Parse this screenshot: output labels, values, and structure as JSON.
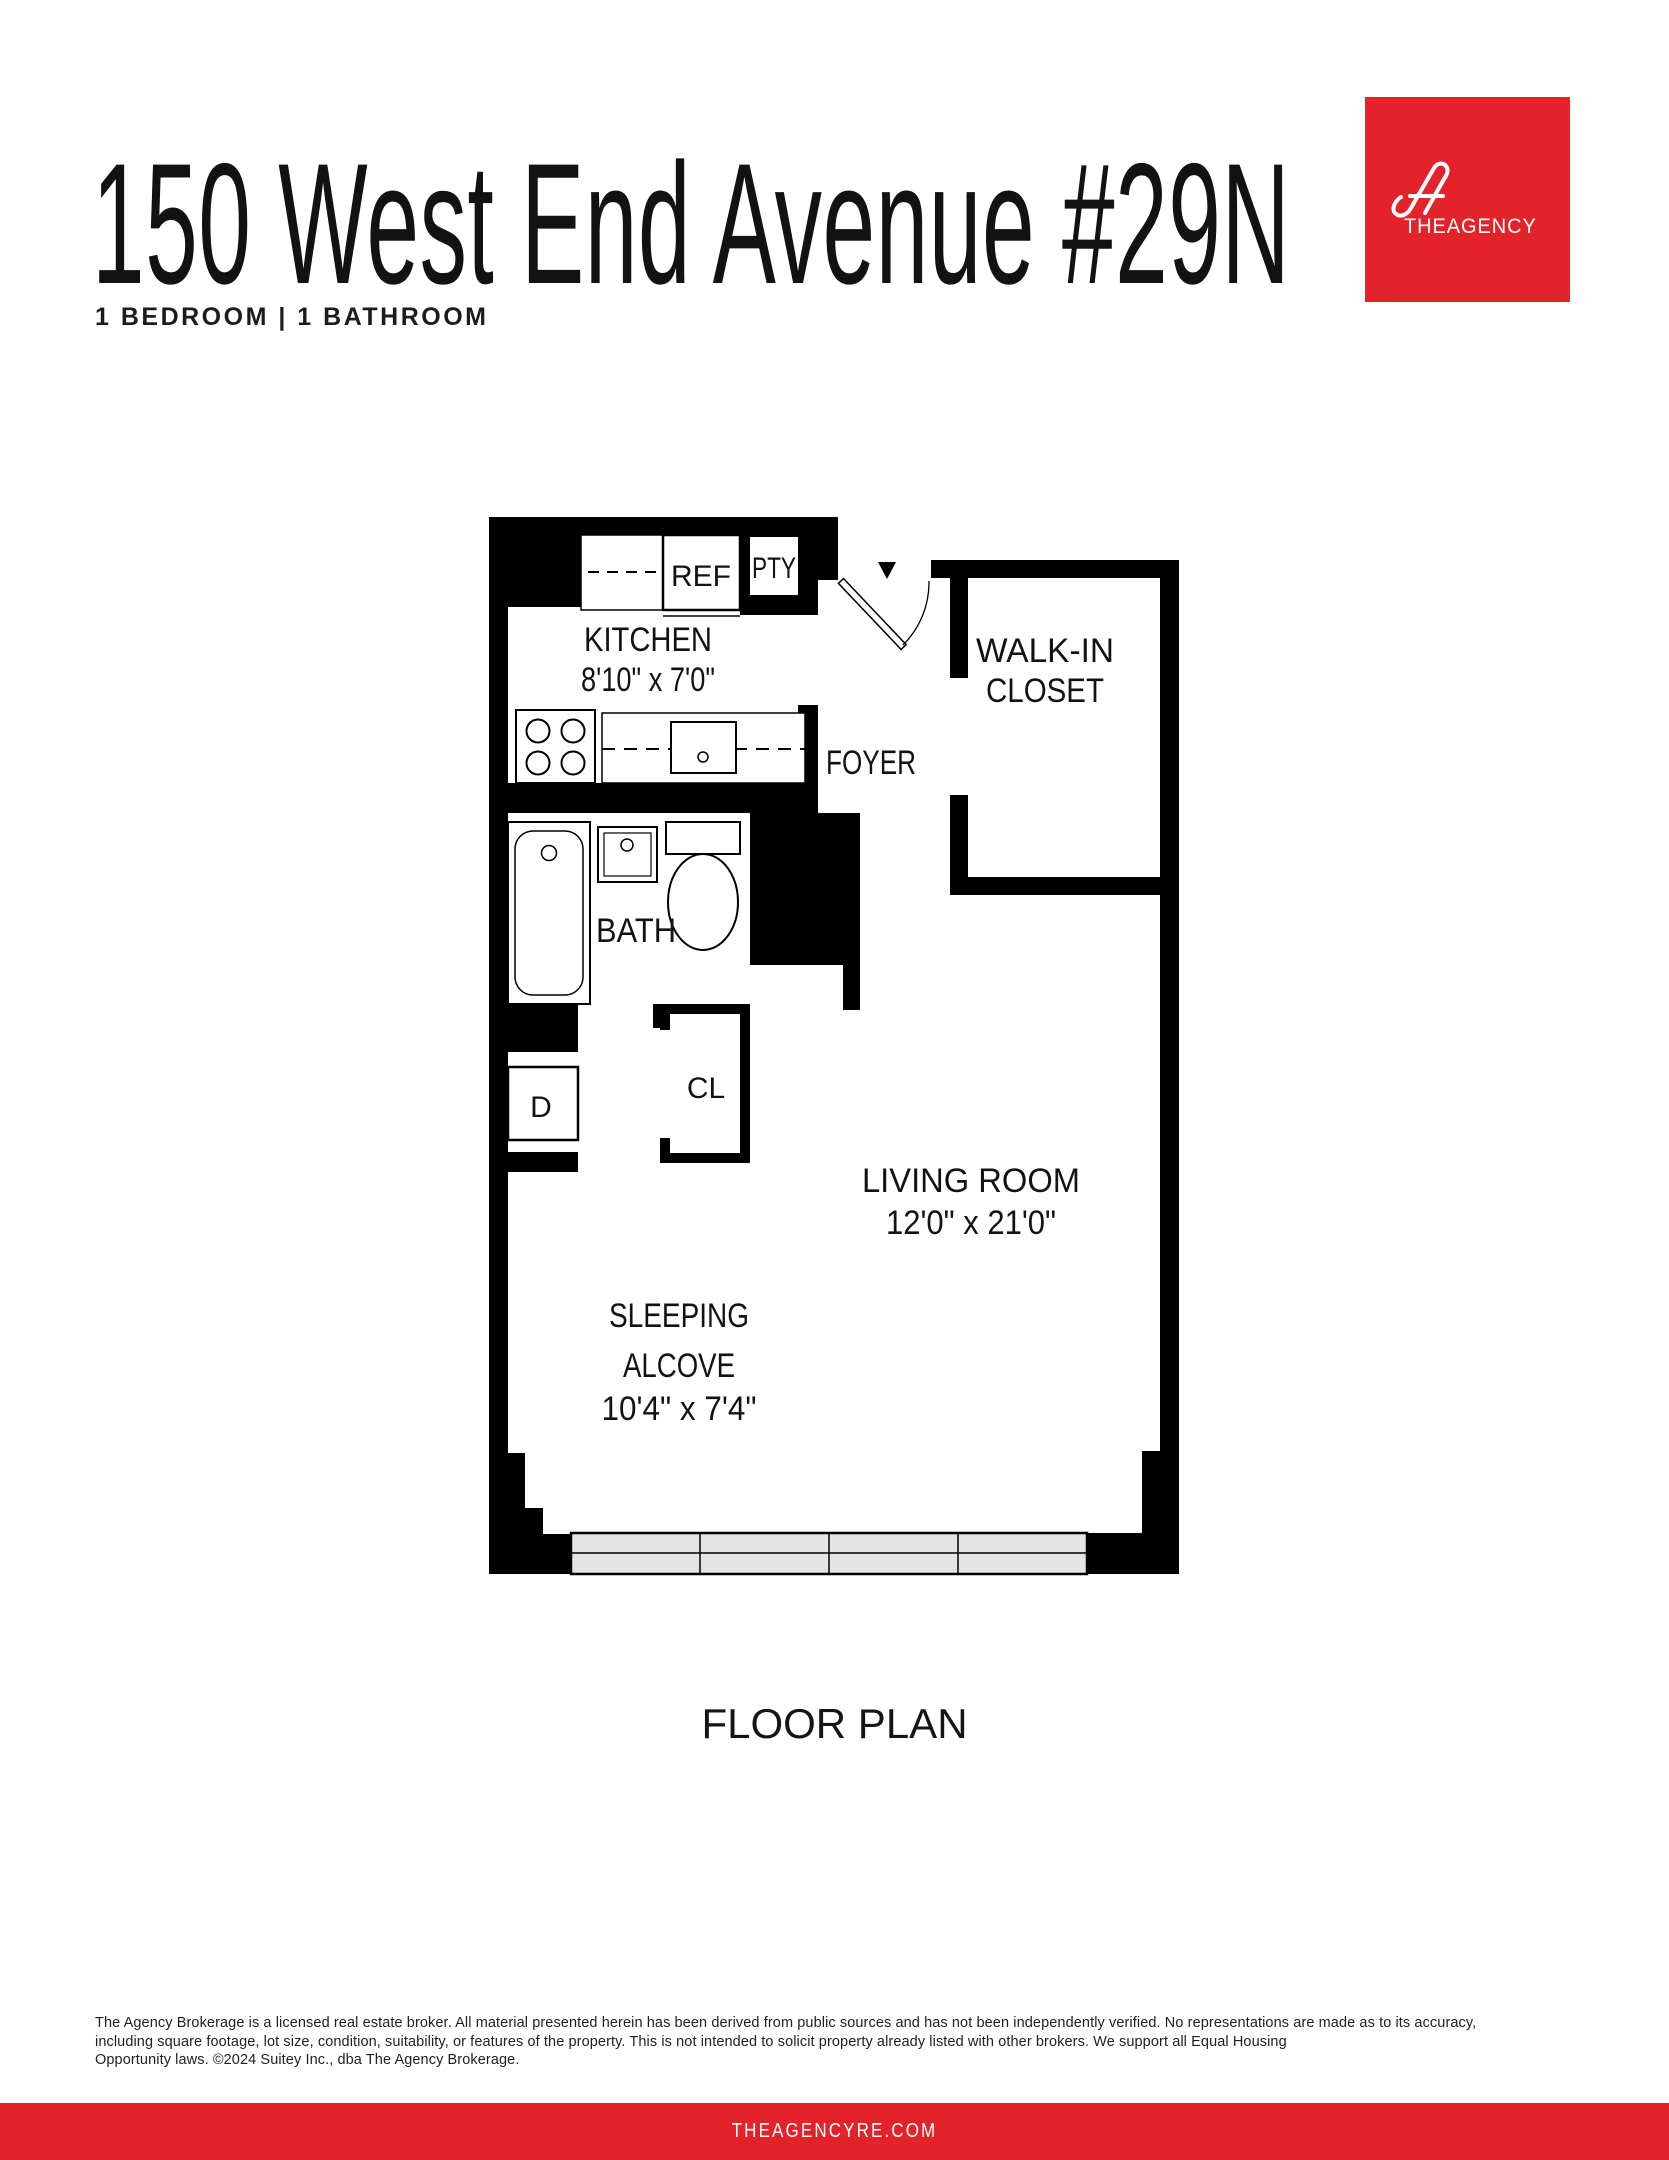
{
  "header": {
    "title": "150 West End Avenue #29N",
    "subtitle": "1 BEDROOM | 1 BATHROOM"
  },
  "logo": {
    "the": "THE",
    "agency": "AGENCY"
  },
  "plan": {
    "caption": "FLOOR PLAN",
    "labels": {
      "kitchen": "KITCHEN",
      "kitchen_dims": "8'10\" x 7'0\"",
      "ref": "REF",
      "pty": "PTY",
      "foyer": "FOYER",
      "walkin_1": "WALK-IN",
      "walkin_2": "CLOSET",
      "bath": "BATH",
      "dryer": "D",
      "closet": "CL",
      "living": "LIVING ROOM",
      "living_dims": "12'0\" x 21'0\"",
      "alcove_1": "SLEEPING",
      "alcove_2": "ALCOVE",
      "alcove_dims": "10'4\" x 7'4\""
    }
  },
  "disclaimer": {
    "line1": "The Agency Brokerage is a licensed real estate broker. All material presented herein has been derived from public sources and has not been independently verified. No representations are made as to its accuracy,",
    "line2": "including square footage, lot size, condition, suitability, or features of the property. This is not intended to solicit property already listed with other brokers. We support all Equal Housing",
    "line3": "Opportunity laws. ©2024 Suitey Inc., dba The Agency Brokerage."
  },
  "footer": {
    "site": "THEAGENCYRE.COM"
  },
  "colors": {
    "brand_red": "#E32329",
    "wall_black": "#000000",
    "window_gray": "#E4E4E4"
  }
}
